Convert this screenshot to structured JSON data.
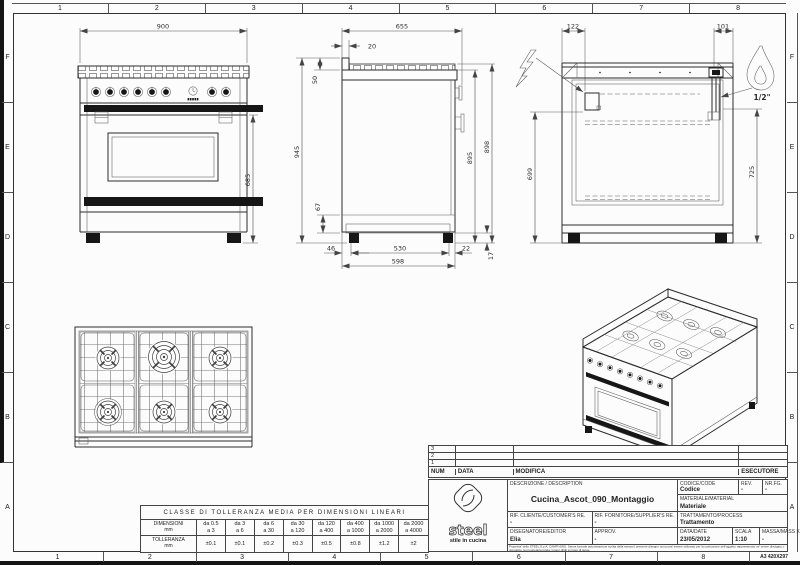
{
  "sheet": {
    "columns": [
      "1",
      "2",
      "3",
      "4",
      "5",
      "6",
      "7",
      "8"
    ],
    "rows": [
      "F",
      "E",
      "D",
      "C",
      "B",
      "A"
    ],
    "format_label": "A3 420X297"
  },
  "views": {
    "front": {
      "dim_width": "900",
      "dim_height": "685"
    },
    "side": {
      "dim_depth": "655",
      "dim_back_offset": "20",
      "dim_splash_height": "50",
      "dim_total_height": "945",
      "dim_plinth_height": "67",
      "dim_body_height": "895",
      "dim_grate_height": "898",
      "dim_rear_foot": "46",
      "dim_foot_span": "530",
      "dim_front_foot": "22",
      "dim_base_depth": "598",
      "dim_foot_height": "17"
    },
    "rear": {
      "dim_electric_offset": "122",
      "dim_gas_offset": "101",
      "dim_electric_height": "699",
      "dim_gas_height": "725",
      "gas_thread": "1/2\""
    }
  },
  "tolerance_table": {
    "title": "CLASSE DI TOLLERANZA MEDIA PER DIMENSIONI LINEARI",
    "dim_label": "DIMENSIONI\nmm",
    "tol_label": "TOLLERANZA\nmm",
    "ranges": [
      "da 0.5\na 3",
      "da 3\na 6",
      "da 6\na 30",
      "da 30\na 120",
      "da 120\na 400",
      "da 400\na 1000",
      "da 1000\na 2000",
      "da 2000\na 4000"
    ],
    "tolerances": [
      "±0.1",
      "±0.1",
      "±0.2",
      "±0.3",
      "±0.5",
      "±0.8",
      "±1.2",
      "±2"
    ]
  },
  "revision_table": {
    "row_numbers": [
      "3",
      "2",
      "1"
    ],
    "headers": {
      "num": "NUM",
      "date": "DATA",
      "modification": "MODIFICA",
      "executor": "ESECUTORE"
    }
  },
  "title_block": {
    "description_label": "DESCRIZIONE / DESCRIPTION",
    "description": "Cucina_Ascot_090_Montaggio",
    "code_label": "CODICE/CODE",
    "code": "Codice",
    "rev_label": "REV.",
    "rev": "-",
    "sheet_label": "NR.FG.",
    "sheet_no": "-",
    "material_label": "MATERIALE/MATERIAL",
    "material": "Materiale",
    "customer_label": "RIF. CLIENTE/CUSTOMER'S RE.",
    "customer": "-",
    "supplier_label": "RIF. FORNITORE/SUPPLIER'S RE.",
    "supplier": "-",
    "treatment_label": "TRATTAMENTO/PROCESS",
    "treatment": "Trattamento",
    "drafter_label": "DISEGNATORE/EDITOR",
    "drafter": "Elia",
    "approval_label": "APPROV.",
    "approval": "-",
    "date_label": "DATA/DATE",
    "date": "23/05/2012",
    "scale_label": "SCALA",
    "scale": "1:10",
    "mass_label": "MASSA/MASS Kg",
    "mass": "-",
    "legal": "Proprieta' dello STEEL S.p.A. CAMPI (MO). Senza formale autorizzazione scritta della stessa il presente disegno non potra' essere utilizzato per la costruzione dell'oggetto rappresentato ne' venire divulgato o riprodotto, la proprietaria tutela i propri diritti a rigore di legge.",
    "logo_text": "steel",
    "logo_tagline": "stile in cucina"
  }
}
